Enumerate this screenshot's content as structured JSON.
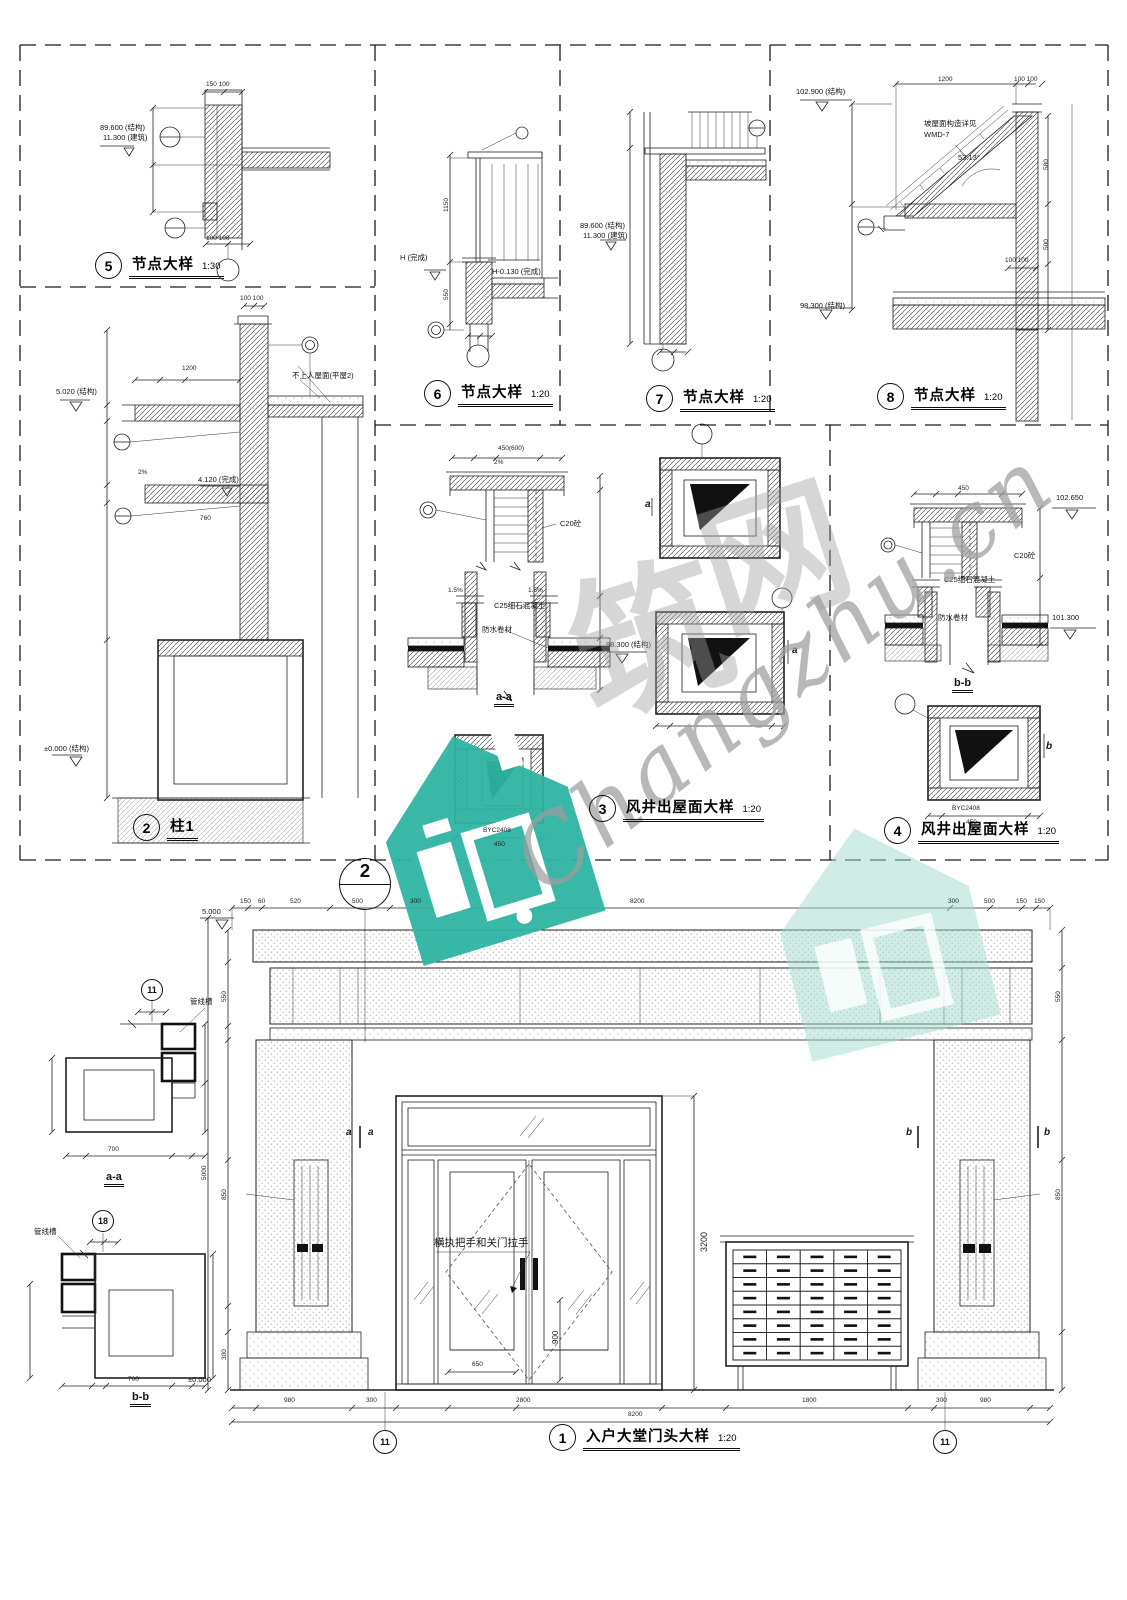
{
  "sheet": {
    "background": "#ffffff",
    "ink": "#1c1c1c",
    "watermark_teal": "#2eb3a2",
    "watermark_gray": "#9a9a9a"
  },
  "mailbox_grid": {
    "rows": 8,
    "cols": 5
  },
  "titles": [
    {
      "num": "5",
      "label": "节点大样",
      "scale": "1:30",
      "x": 95,
      "y": 252
    },
    {
      "num": "2",
      "label": "柱1",
      "scale": "",
      "x": 133,
      "y": 814
    },
    {
      "num": "6",
      "label": "节点大样",
      "scale": "1:20",
      "x": 424,
      "y": 380
    },
    {
      "num": "7",
      "label": "节点大样",
      "scale": "1:20",
      "x": 646,
      "y": 385
    },
    {
      "num": "8",
      "label": "节点大样",
      "scale": "1:20",
      "x": 877,
      "y": 383
    },
    {
      "num": "3",
      "label": "风井出屋面大样",
      "scale": "1:20",
      "x": 589,
      "y": 795
    },
    {
      "num": "4",
      "label": "风井出屋面大样",
      "scale": "1:20",
      "x": 884,
      "y": 817
    },
    {
      "num": "1",
      "label": "入户大堂门头大样",
      "scale": "1:20",
      "x": 549,
      "y": 1424
    }
  ],
  "callouts": [
    {
      "n": "2",
      "x": 365,
      "y": 884,
      "r": 26,
      "split": true
    },
    {
      "n": "11",
      "x": 152,
      "y": 990,
      "r": 11
    },
    {
      "n": "18",
      "x": 103,
      "y": 1221,
      "r": 11
    },
    {
      "n": "11",
      "x": 385,
      "y": 1442,
      "r": 12
    },
    {
      "n": "11",
      "x": 945,
      "y": 1442,
      "r": 12
    }
  ],
  "labels": [
    {
      "t": "89.600 (结构)",
      "x": 100,
      "y": 124,
      "c": "lvl"
    },
    {
      "t": "11.300 (建筑)",
      "x": 103,
      "y": 134,
      "c": "lvl"
    },
    {
      "t": "150 100",
      "x": 206,
      "y": 82,
      "c": "dim"
    },
    {
      "t": "100 100",
      "x": 206,
      "y": 236,
      "c": "dim"
    },
    {
      "t": "100 100",
      "x": 240,
      "y": 296,
      "c": "dim"
    },
    {
      "t": "5.020 (结构)",
      "x": 56,
      "y": 388,
      "c": "lvl"
    },
    {
      "t": "1200",
      "x": 182,
      "y": 366,
      "c": "dim"
    },
    {
      "t": "不上人屋面(平屋2)",
      "x": 292,
      "y": 372,
      "c": "note"
    },
    {
      "t": "4.120 (完成)",
      "x": 198,
      "y": 476,
      "c": "lvl"
    },
    {
      "t": "2%",
      "x": 138,
      "y": 470,
      "c": "dim"
    },
    {
      "t": "760",
      "x": 200,
      "y": 516,
      "c": "dim"
    },
    {
      "t": "±0.000 (结构)",
      "x": 44,
      "y": 745,
      "c": "lvl"
    },
    {
      "t": "H (完成)",
      "x": 400,
      "y": 254,
      "c": "lvl"
    },
    {
      "t": "1150",
      "x": 444,
      "y": 212,
      "r": -90,
      "c": "dim"
    },
    {
      "t": "550",
      "x": 444,
      "y": 300,
      "r": -90,
      "c": "dim"
    },
    {
      "t": "H-0.130 (完成)",
      "x": 492,
      "y": 268,
      "c": "lvl"
    },
    {
      "t": "89.600 (结构)",
      "x": 580,
      "y": 222,
      "c": "lvl"
    },
    {
      "t": "11.300 (建筑)",
      "x": 583,
      "y": 232,
      "c": "lvl"
    },
    {
      "t": "102.900 (结构)",
      "x": 796,
      "y": 88,
      "c": "lvl"
    },
    {
      "t": "1200",
      "x": 938,
      "y": 77,
      "c": "dim"
    },
    {
      "t": "100 100",
      "x": 1014,
      "y": 77,
      "c": "dim"
    },
    {
      "t": "坡屋面构造详见",
      "x": 924,
      "y": 120,
      "c": "note"
    },
    {
      "t": "WMD-7",
      "x": 924,
      "y": 131,
      "c": "note"
    },
    {
      "t": "53.13°",
      "x": 958,
      "y": 154,
      "c": "note"
    },
    {
      "t": "580",
      "x": 1044,
      "y": 170,
      "r": -90,
      "c": "dim"
    },
    {
      "t": "500",
      "x": 1044,
      "y": 250,
      "r": -90,
      "c": "dim"
    },
    {
      "t": "100 100",
      "x": 1005,
      "y": 258,
      "c": "dim"
    },
    {
      "t": "98.300 (结构)",
      "x": 800,
      "y": 302,
      "c": "lvl"
    },
    {
      "t": "450(600)",
      "x": 498,
      "y": 446,
      "c": "dim"
    },
    {
      "t": "2%",
      "x": 494,
      "y": 460,
      "c": "dim"
    },
    {
      "t": "C20砼",
      "x": 560,
      "y": 520,
      "c": "note"
    },
    {
      "t": "C25细石混凝土",
      "x": 494,
      "y": 602,
      "c": "note"
    },
    {
      "t": "防水卷材",
      "x": 482,
      "y": 626,
      "c": "note"
    },
    {
      "t": "1.5%",
      "x": 448,
      "y": 588,
      "c": "dim"
    },
    {
      "t": "1.5%",
      "x": 528,
      "y": 588,
      "c": "dim"
    },
    {
      "t": "98.300 (结构)",
      "x": 606,
      "y": 641,
      "c": "lvl"
    },
    {
      "t": "a-a",
      "x": 494,
      "y": 692,
      "c": "sec"
    },
    {
      "t": "BYC2408",
      "x": 483,
      "y": 828,
      "c": "dim"
    },
    {
      "t": "450",
      "x": 494,
      "y": 842,
      "c": "dim"
    },
    {
      "t": "a",
      "x": 645,
      "y": 500,
      "c": "big"
    },
    {
      "t": "a",
      "x": 792,
      "y": 646,
      "c": "big"
    },
    {
      "t": "450",
      "x": 958,
      "y": 486,
      "c": "dim"
    },
    {
      "t": "102.650",
      "x": 1056,
      "y": 494,
      "c": "lvl"
    },
    {
      "t": "C20砼",
      "x": 1014,
      "y": 552,
      "c": "note"
    },
    {
      "t": "C25细石混凝土",
      "x": 944,
      "y": 576,
      "c": "note"
    },
    {
      "t": "防水卷材",
      "x": 938,
      "y": 614,
      "c": "note"
    },
    {
      "t": "101.300",
      "x": 1052,
      "y": 614,
      "c": "lvl"
    },
    {
      "t": "b-b",
      "x": 952,
      "y": 678,
      "c": "sec"
    },
    {
      "t": "b",
      "x": 1046,
      "y": 742,
      "c": "big"
    },
    {
      "t": "BYC2408",
      "x": 952,
      "y": 806,
      "c": "dim"
    },
    {
      "t": "450",
      "x": 966,
      "y": 820,
      "c": "dim"
    },
    {
      "t": "管线槽",
      "x": 190,
      "y": 998,
      "c": "note"
    },
    {
      "t": "700",
      "x": 108,
      "y": 1147,
      "c": "dim"
    },
    {
      "t": "a-a",
      "x": 104,
      "y": 1172,
      "c": "sec"
    },
    {
      "t": "管线槽",
      "x": 34,
      "y": 1228,
      "c": "note"
    },
    {
      "t": "700",
      "x": 128,
      "y": 1377,
      "c": "dim"
    },
    {
      "t": "b-b",
      "x": 130,
      "y": 1392,
      "c": "sec"
    },
    {
      "t": "5.000",
      "x": 202,
      "y": 908,
      "c": "lvl"
    },
    {
      "t": "150",
      "x": 240,
      "y": 899,
      "c": "dim"
    },
    {
      "t": "60",
      "x": 258,
      "y": 899,
      "c": "dim"
    },
    {
      "t": "520",
      "x": 290,
      "y": 899,
      "c": "dim"
    },
    {
      "t": "500",
      "x": 352,
      "y": 899,
      "c": "dim"
    },
    {
      "t": "300",
      "x": 410,
      "y": 899,
      "c": "dim"
    },
    {
      "t": "8200",
      "x": 630,
      "y": 899,
      "c": "dim"
    },
    {
      "t": "300",
      "x": 948,
      "y": 899,
      "c": "dim"
    },
    {
      "t": "500",
      "x": 984,
      "y": 899,
      "c": "dim"
    },
    {
      "t": "150",
      "x": 1016,
      "y": 899,
      "c": "dim"
    },
    {
      "t": "150",
      "x": 1034,
      "y": 899,
      "c": "dim"
    },
    {
      "t": "a",
      "x": 346,
      "y": 1128,
      "c": "big"
    },
    {
      "t": "a",
      "x": 368,
      "y": 1128,
      "c": "big"
    },
    {
      "t": "b",
      "x": 906,
      "y": 1128,
      "c": "big"
    },
    {
      "t": "b",
      "x": 1044,
      "y": 1128,
      "c": "big"
    },
    {
      "t": "横执把手和关门拉手",
      "x": 434,
      "y": 1238,
      "c": "note",
      "s": 10.5
    },
    {
      "t": "3200",
      "x": 700,
      "y": 1252,
      "r": -90,
      "c": "dim",
      "s": 9
    },
    {
      "t": "900",
      "x": 552,
      "y": 1344,
      "r": -90,
      "c": "dim",
      "s": 8
    },
    {
      "t": "650",
      "x": 472,
      "y": 1362,
      "c": "dim"
    },
    {
      "t": "550",
      "x": 222,
      "y": 1002,
      "r": -90,
      "c": "dim"
    },
    {
      "t": "850",
      "x": 222,
      "y": 1200,
      "r": -90,
      "c": "dim"
    },
    {
      "t": "300",
      "x": 222,
      "y": 1360,
      "r": -90,
      "c": "dim"
    },
    {
      "t": "5000",
      "x": 202,
      "y": 1180,
      "r": -90,
      "c": "dim"
    },
    {
      "t": "550",
      "x": 1056,
      "y": 1002,
      "r": -90,
      "c": "dim"
    },
    {
      "t": "850",
      "x": 1056,
      "y": 1200,
      "r": -90,
      "c": "dim"
    },
    {
      "t": "980",
      "x": 284,
      "y": 1398,
      "c": "dim"
    },
    {
      "t": "300",
      "x": 366,
      "y": 1398,
      "c": "dim"
    },
    {
      "t": "2800",
      "x": 516,
      "y": 1398,
      "c": "dim"
    },
    {
      "t": "1800",
      "x": 802,
      "y": 1398,
      "c": "dim"
    },
    {
      "t": "300",
      "x": 936,
      "y": 1398,
      "c": "dim"
    },
    {
      "t": "980",
      "x": 980,
      "y": 1398,
      "c": "dim"
    },
    {
      "t": "8200",
      "x": 628,
      "y": 1412,
      "c": "dim"
    },
    {
      "t": "±0.000",
      "x": 188,
      "y": 1376,
      "c": "lvl"
    },
    {
      "t": "筑",
      "x": 552,
      "y": 590,
      "c": "wm",
      "s": 155,
      "r": -18
    },
    {
      "t": "网",
      "x": 684,
      "y": 512,
      "c": "wm",
      "s": 145,
      "r": -18
    },
    {
      "t": "Changzhu.cn",
      "x": 498,
      "y": 836,
      "c": "wms",
      "r": -38
    }
  ]
}
